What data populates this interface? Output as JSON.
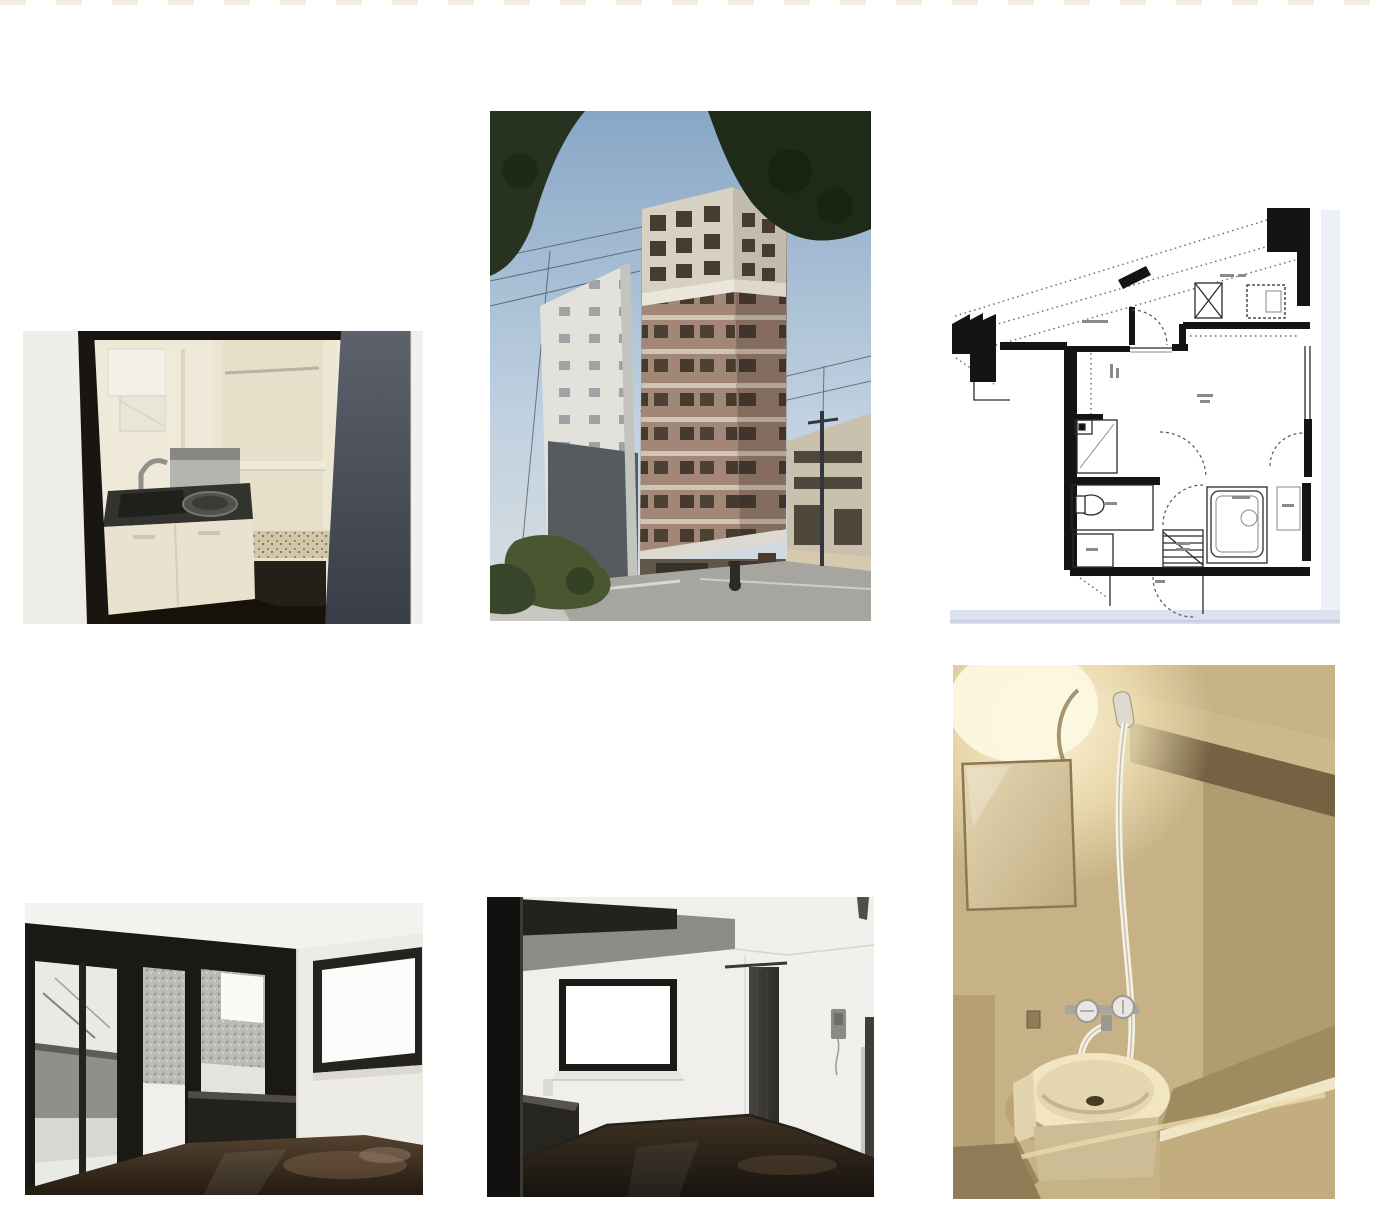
{
  "page": {
    "background": "#ffffff",
    "top_edge_dash_color": "#f2ebdf"
  },
  "gallery": {
    "name": "apartment-photo-collage",
    "photos": [
      {
        "id": "kitchen",
        "label": "Kitchenette photo",
        "desc": "Compact cream kitchenette with sink, burner and open shelving seen through a dark door frame"
      },
      {
        "id": "building-exterior",
        "label": "Building exterior photo",
        "desc": "Tall brown apartment tower against blue sky with neighbouring white building, low houses and street"
      },
      {
        "id": "floor-plan",
        "label": "Floor plan drawing",
        "desc": "Black-and-white one-room apartment floor plan with angled balcony, elevator, toilet, bath and stairs"
      },
      {
        "id": "room-balcony",
        "label": "Room with balcony doors photo",
        "desc": "Empty room with dark glossy floor and black-framed sliding glass doors to a balcony"
      },
      {
        "id": "room-window",
        "label": "Room with window photo",
        "desc": "Empty room with bright window, dark counter, dark curtain and intercom on white wall"
      },
      {
        "id": "bathroom",
        "label": "Bathroom photo",
        "desc": "Warm-lit unit bathroom with mirror, hanging hand shower, wash basin and bathtub"
      }
    ]
  },
  "palette": {
    "photo_floor_dark": "#2e2419",
    "building_brick": "#9a7f6f",
    "sky_blue": "#8fadc9",
    "bathroom_tan": "#c2ac80",
    "plan_walls": "#141414",
    "plan_edge_tint": "#dce1ee",
    "slate_wall": "#535863",
    "cream_cabinet": "#efe9da"
  }
}
